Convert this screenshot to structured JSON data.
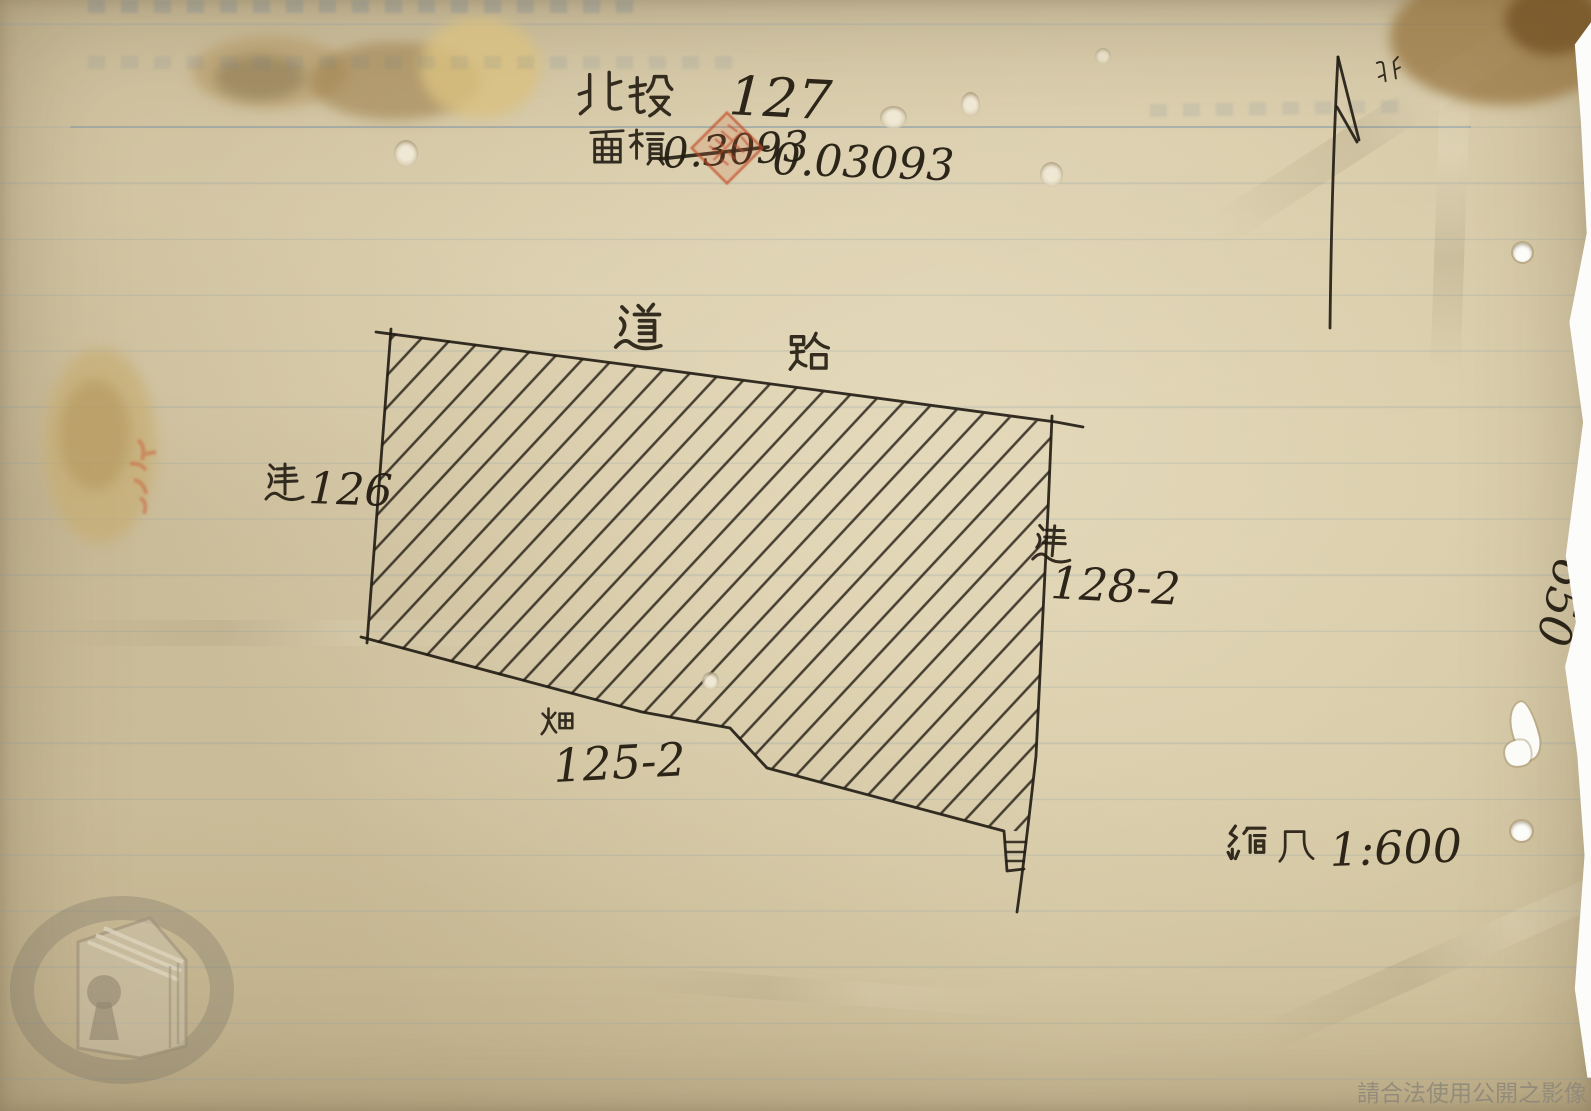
{
  "page": {
    "header": {
      "district": "北投",
      "parcel_number": "127"
    },
    "area": {
      "label": "面積",
      "crossed_out_value": "0.3093",
      "corrected_value": "0.03093"
    },
    "compass": {
      "label": "北"
    },
    "map": {
      "road_label": "道路",
      "parcel_left": {
        "type": "建",
        "number": "126"
      },
      "parcel_right": {
        "type": "建",
        "number": "128-2"
      },
      "parcel_bottom": {
        "type": "畑",
        "number": "125-2"
      }
    },
    "scale": {
      "label": "縮尺",
      "ratio": "1:600"
    },
    "margin_note": "650",
    "footer": {
      "watermark_text": "請合法使用公開之影像"
    },
    "stamp": {
      "seal_color": "#c14e28"
    },
    "ink_color": "#221d16"
  }
}
